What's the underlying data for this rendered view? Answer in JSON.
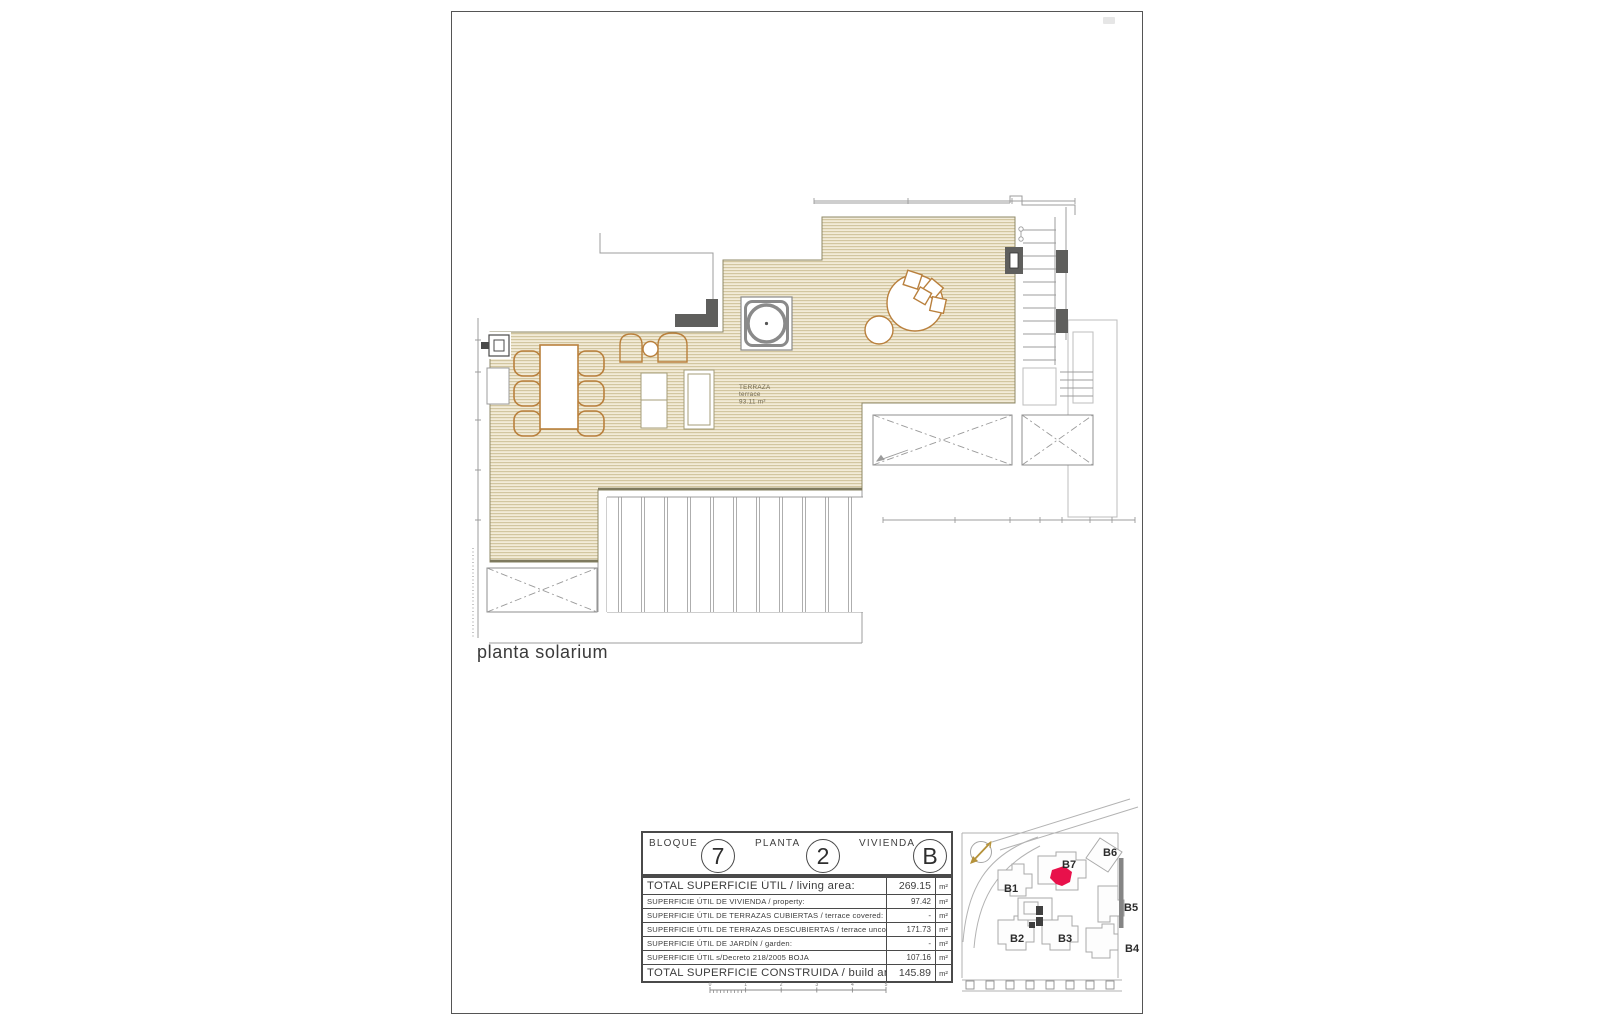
{
  "sheet": {
    "drawing_label": "planta solarium"
  },
  "plan": {
    "terrace": {
      "l1": "TERRAZA",
      "l2": "terrace",
      "l3": "93.11 m²"
    }
  },
  "title_block": {
    "fields": [
      {
        "label": "BLOQUE",
        "value": "7"
      },
      {
        "label": "PLANTA",
        "value": "2"
      },
      {
        "label": "VIVIENDA",
        "value": "B"
      }
    ],
    "rows": [
      {
        "label": "TOTAL SUPERFICIE ÚTIL / living area:",
        "value": "269.15",
        "unit": "m²"
      },
      {
        "label": "SUPERFICIE ÚTIL DE VIVIENDA / property:",
        "value": "97.42",
        "unit": "m²"
      },
      {
        "label": "SUPERFICIE ÚTIL DE TERRAZAS CUBIERTAS / terrace covered:",
        "value": "-",
        "unit": "m²"
      },
      {
        "label": "SUPERFICIE ÚTIL DE TERRAZAS DESCUBIERTAS / terrace uncovered:",
        "value": "171.73",
        "unit": "m²"
      },
      {
        "label": "SUPERFICIE ÚTIL DE JARDÍN / garden:",
        "value": "-",
        "unit": "m²"
      },
      {
        "label": "SUPERFICIE ÚTIL s/Decreto 218/2005 BOJA",
        "value": "107.16",
        "unit": "m²"
      },
      {
        "label": "TOTAL SUPERFICIE CONSTRUIDA / build area:",
        "value": "145.89",
        "unit": "m²"
      }
    ],
    "scale": [
      "0",
      "1",
      "2",
      "3",
      "4",
      "5"
    ]
  },
  "site_map": {
    "labels": [
      "B1",
      "B2",
      "B3",
      "B4",
      "B5",
      "B6",
      "B7"
    ],
    "highlight_color": "#e8114b",
    "compass_icon": "north-arrow"
  },
  "colors": {
    "terrace_bg": "#f2ebd8",
    "terrace_hatch_line": "#c8b98d",
    "furniture_outline": "#b9803d",
    "wall_dark": "#5f5f5d",
    "thin_line": "#9c9c9c",
    "highlight_red": "#e8114b"
  }
}
